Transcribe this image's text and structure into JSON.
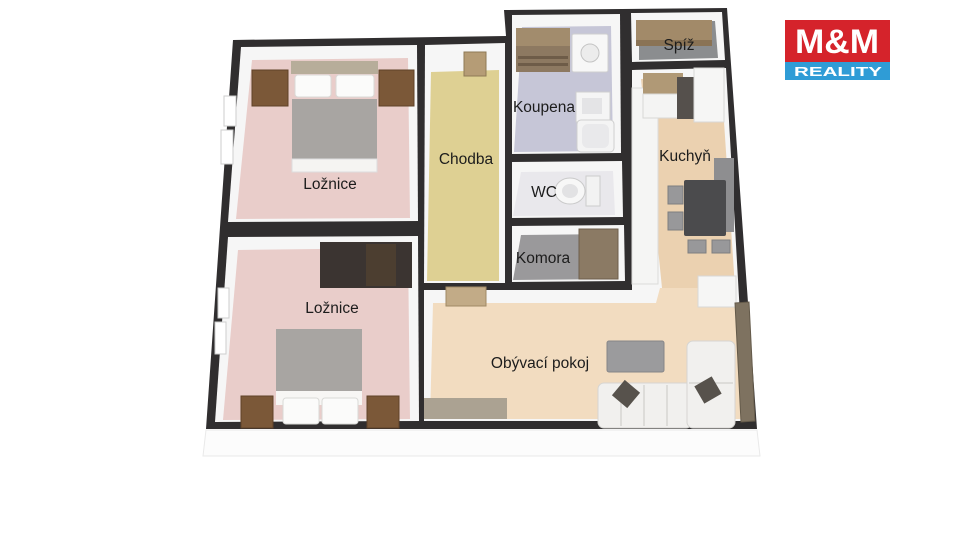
{
  "logo": {
    "line1": "M&M",
    "line2": "REALITY",
    "red": "#d5232b",
    "blue": "#2f9cd6",
    "text_color": "#ffffff"
  },
  "plan": {
    "wall_color": "#302e2f",
    "wall_face_color": "#f6f6f6",
    "outer_face_color": "#fcfcfc",
    "rooms": {
      "bedroom1": {
        "label": "Ložnice",
        "floor_color": "#e9cdca"
      },
      "bedroom2": {
        "label": "Ložnice",
        "floor_color": "#e9cdca"
      },
      "hallway": {
        "label": "Chodba",
        "floor_color": "#ded093"
      },
      "bathroom": {
        "label": "Koupena",
        "floor_color": "#c6c6d7"
      },
      "wc": {
        "label": "WC",
        "floor_color": "#e9e8ec"
      },
      "closet": {
        "label": "Komora",
        "floor_color": "#9a999b"
      },
      "pantry": {
        "label": "Spíž",
        "floor_color": "#8b8d8f"
      },
      "kitchen": {
        "label": "Kuchyň",
        "floor_color": "#ebd1b0"
      },
      "living_room": {
        "label": "Obývací pokoj",
        "floor_color": "#f2dcc0"
      }
    }
  }
}
